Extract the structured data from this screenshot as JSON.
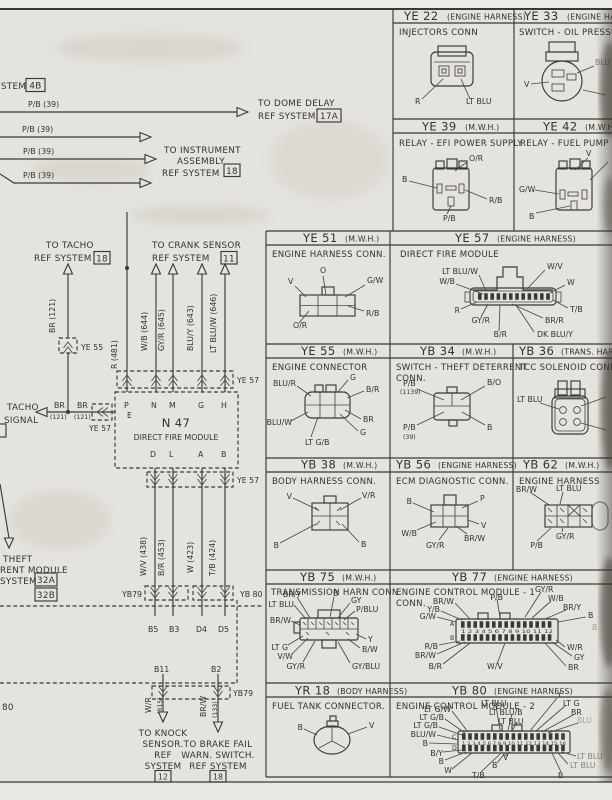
{
  "page": {
    "bg": "#e5e3dd",
    "ink": "#3b3934",
    "gutter_shadow": "#2f2c26"
  },
  "left": {
    "system_fragment": "STEM",
    "system_ref": "4B",
    "pb_label": "P/B (39)",
    "dome": {
      "l1": "TO DOME DELAY",
      "l2": "REF SYSTEM",
      "ref": "17A"
    },
    "instrument": {
      "l1": "TO INSTRUMENT",
      "l2": "ASSEMBLY",
      "l3": "REF SYSTEM",
      "ref": "18"
    },
    "tacho": {
      "l1": "TO TACHO",
      "l2": "REF SYSTEM",
      "ref": "18"
    },
    "crank": {
      "l1": "TO CRANK SENSOR",
      "l2": "REF SYSTEM",
      "ref": "11"
    },
    "w_r481": "R (481)",
    "w_wb644": "W/B (644)",
    "w_gyr645": "GY/R (645)",
    "w_bluy643": "BLU/Y (643)",
    "w_ltbluw646": "LT BLU/W (646)",
    "w_br_vert": "BR (121)",
    "ye55": "YE 55",
    "ye57": "YE 57",
    "yb79": "YB79",
    "yb80": "YB 80",
    "tacho_sig1": "TACHO",
    "tacho_sig2": "SIGNAL",
    "br": "BR",
    "br_num": "(121)",
    "n47": "N 47",
    "n47_sub": "DIRECT FIRE MODULE",
    "pin_p": "P",
    "pin_e": "E",
    "pin_n": "N",
    "pin_m": "M",
    "pin_g": "G",
    "pin_h": "H",
    "pin_d": "D",
    "pin_l": "L",
    "pin_a": "A",
    "pin_b": "B",
    "w_wv438": "W/V (438)",
    "w_br453": "B/R (453)",
    "w_w423": "W (423)",
    "w_tb424": "T/B (424)",
    "b5": "B5",
    "b3": "B3",
    "d4": "D4",
    "d5": "D5",
    "b11": "B11",
    "b2": "B2",
    "w_wr": "W/R",
    "w_wr_num": "(815)",
    "w_brw": "BR/W",
    "w_brw_num": "(133)",
    "knock": {
      "l1": "TO KNOCK",
      "l2": "SENSOR.",
      "l3": "REF",
      "l4": "SYSTEM",
      "ref": "12"
    },
    "brake": {
      "l1": "TO BRAKE FAIL",
      "l2": "WARN. SWITCH.",
      "l3": "REF SYSTEM",
      "ref": "18"
    },
    "theft": {
      "l1": "THEFT",
      "l2": "RENT MODULE",
      "l3": "SYSTEM",
      "refA": "32A",
      "refB": "32B"
    },
    "edge80": "80"
  },
  "boxes": {
    "ye22": {
      "code": "YE 22",
      "qual": "(ENGINE HARNESS)",
      "subtitle": "INJECTORS  CONN",
      "pins": [
        "R",
        "LT BLU"
      ]
    },
    "ye33": {
      "code": "YE 33",
      "qual": "(ENGINE HARNESS)",
      "subtitle": "SWITCH - OIL PRESSURE",
      "pins": [
        "V",
        "BLU"
      ]
    },
    "ye39": {
      "code": "YE 39",
      "qual": "(M.W.H.)",
      "subtitle": "RELAY - EFI POWER SUPPLY",
      "pins": [
        "O/R",
        "B",
        "R/B",
        "P/B"
      ]
    },
    "ye42": {
      "code": "YE 42",
      "qual": "(M.W.H.)",
      "subtitle": "RELAY - FUEL PUMP",
      "pins": [
        "V",
        "G/W",
        "B"
      ]
    },
    "ye51": {
      "code": "YE 51",
      "qual": "(M.W.H.)",
      "subtitle": "ENGINE HARNESS CONN.",
      "pins": [
        "V",
        "O",
        "G/W",
        "R/B",
        "O/R"
      ]
    },
    "ye57": {
      "code": "YE 57",
      "qual": "(ENGINE HARNESS)",
      "subtitle": "DIRECT FIRE MODULE",
      "pins": [
        "LT BLU/W",
        "W/B",
        "W/V",
        "W",
        "R",
        "GY/R",
        "B/R",
        "DK BLU/Y",
        "BR/R",
        "T/B"
      ]
    },
    "ye55": {
      "code": "YE 55",
      "qual": "(M.W.H.)",
      "subtitle": "ENGINE CONNECTOR",
      "pins": [
        "BLU/R",
        "G",
        "B/R",
        "BLU/W",
        "BR",
        "G",
        "LT G/B"
      ]
    },
    "yb34": {
      "code": "YB 34",
      "qual": "(M.W.H.)",
      "subtitle": "SWITCH - THEFT DETERRENT",
      "subtitle2": "CONN.",
      "pins": [
        "P/B",
        "(1139)",
        "B/O",
        "P/B",
        "(39)",
        "B"
      ]
    },
    "yb36": {
      "code": "YB 36",
      "qual": "(TRANS. HARN.)",
      "subtitle": "TCC SOLENOID CONN",
      "pins": [
        "LT BLU"
      ]
    },
    "yb38": {
      "code": "YB 38",
      "qual": "(M.W.H.)",
      "subtitle": "BODY HARNESS CONN.",
      "pins": [
        "V",
        "V/R",
        "B",
        "B"
      ]
    },
    "yb56": {
      "code": "YB 56",
      "qual": "(ENGINE HARNESS)",
      "subtitle": "ECM DIAGNOSTIC CONN.",
      "pins": [
        "B",
        "P",
        "W/B",
        "GY/R",
        "BR/W",
        "V"
      ]
    },
    "yb62": {
      "code": "YB 62",
      "qual": "(M.W.H.)",
      "subtitle": "ENGINE HARNESS",
      "pins": [
        "BR/W",
        "LT BLU",
        "P/B",
        "GY/R"
      ]
    },
    "yb75": {
      "code": "YB 75",
      "qual": "(M.W.H.)",
      "subtitle": "TRANSMISSION HARN CONN.",
      "pins": [
        "BR/Y",
        "LT BLU",
        "BR/W",
        "B",
        "GY",
        "P/BLU",
        "LT G",
        "V/W",
        "GY/R",
        "Y",
        "B/W",
        "GY/BLU"
      ]
    },
    "yb77": {
      "code": "YB 77",
      "qual": "(ENGINE HARNESS)",
      "subtitle": "ENGINE CONTROL MODULE - 1",
      "subtitle2": "CONN.",
      "rows": [
        "A",
        "B"
      ],
      "nums": "1 2 3 4 5 6 7 8 9 10 11 12",
      "pins": [
        "P/B",
        "GY/R",
        "W/B",
        "BR/Y",
        "B",
        "BR/W",
        "Y/B",
        "G/W",
        "R/B",
        "BR/W",
        "B/R",
        "W/V",
        "W/R",
        "GY",
        "BR"
      ]
    },
    "yr18": {
      "code": "YR 18",
      "qual": "(BODY HARNESS)",
      "subtitle": "FUEL TANK CONNECTOR.",
      "pins": [
        "B",
        "V"
      ]
    },
    "yb80": {
      "code": "YB 80",
      "qual": "(ENGINE HARNESS)",
      "subtitle": "ENGINE CONTROL MODULE - 2",
      "rows": [
        "C",
        "D"
      ],
      "nums": "1 2 3 4 5 6 7 8 9 10 11 12 13 14 15 16",
      "pins_left": [
        "LT G/W",
        "LT G/B",
        "LT G/B",
        "BLU/W",
        "B",
        "B/Y",
        "B",
        "W"
      ],
      "pins_top": [
        "LT BLU",
        "LT BLU/B",
        "LT BLU",
        "Y",
        "LT G",
        "BR",
        "BLU"
      ],
      "pins_right": [
        "LT BLU",
        "LT BLU"
      ],
      "pins_bottom": [
        "V",
        "B",
        "T/B",
        "B"
      ]
    }
  }
}
